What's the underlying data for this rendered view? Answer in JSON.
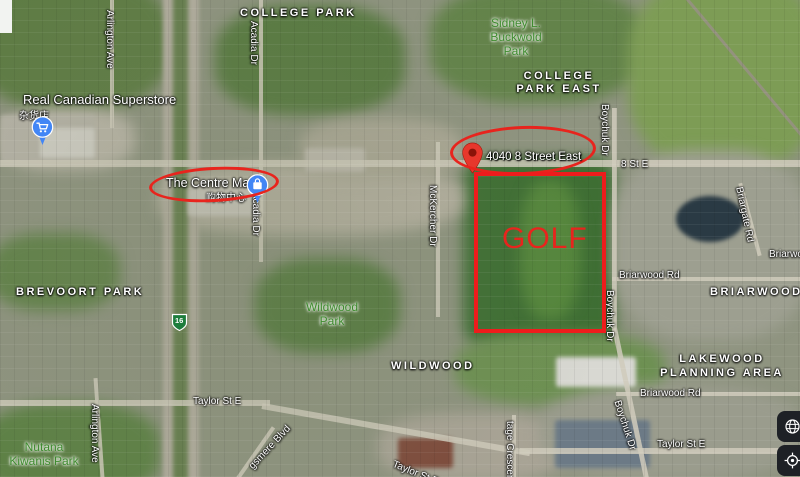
{
  "colors": {
    "annotation_red": "#e8241d",
    "pin_blue": "#4286f5",
    "pin_red": "#e7372c",
    "park_label_green": "#3e8b2e"
  },
  "annotations": {
    "golf_label": "GOLF",
    "address_label": "4040 8 Street East"
  },
  "pois": {
    "superstore": {
      "name": "Real Canadian Superstore",
      "name_cn": "杂货店"
    },
    "centre_mall": {
      "name": "The Centre Mall",
      "name_cn": "购物中心"
    }
  },
  "neighborhoods": {
    "college_park": "COLLEGE PARK",
    "college_park_east_l1": "COLLEGE",
    "college_park_east_l2": "PARK EAST",
    "brevoort_park": "BREVOORT PARK",
    "wildwood": "WILDWOOD",
    "briarwood": "BRIARWOOD",
    "lakewood_l1": "LAKEWOOD",
    "lakewood_l2": "PLANNING AREA"
  },
  "parks": {
    "sidney_l1": "Sidney L.",
    "sidney_l2": "Buckwold",
    "sidney_l3": "Park",
    "wildwood_l1": "Wildwood",
    "wildwood_l2": "Park",
    "nutana_l1": "Nutana",
    "nutana_l2": "Kiwanis Park"
  },
  "streets": {
    "arlington_top": "Arlington Ave",
    "arlington_bottom": "Arlington Ave",
    "acadia_top": "Acadia Dr",
    "acadia_mid": "Acadia Dr",
    "mckercher": "McKercher Dr",
    "boychuk_top": "Boychuk Dr",
    "boychuk_mid": "Boychuk Dr",
    "boychuk_bottom": "Boychuk Dr",
    "eighth_st": "8 St E",
    "briargate": "Briargate Rd",
    "briarwood_upper": "Briarwood Rd",
    "briarwood_right": "Briarwood Rd",
    "briarwood_lower": "Briarwood Rd",
    "taylor_left": "Taylor St E",
    "taylor_right": "Taylor St E",
    "taylor_diag": "Taylor St E",
    "heritage": "tage Crescent",
    "kingsmere": "gsmere Blvd",
    "hwy_shield": "16"
  }
}
